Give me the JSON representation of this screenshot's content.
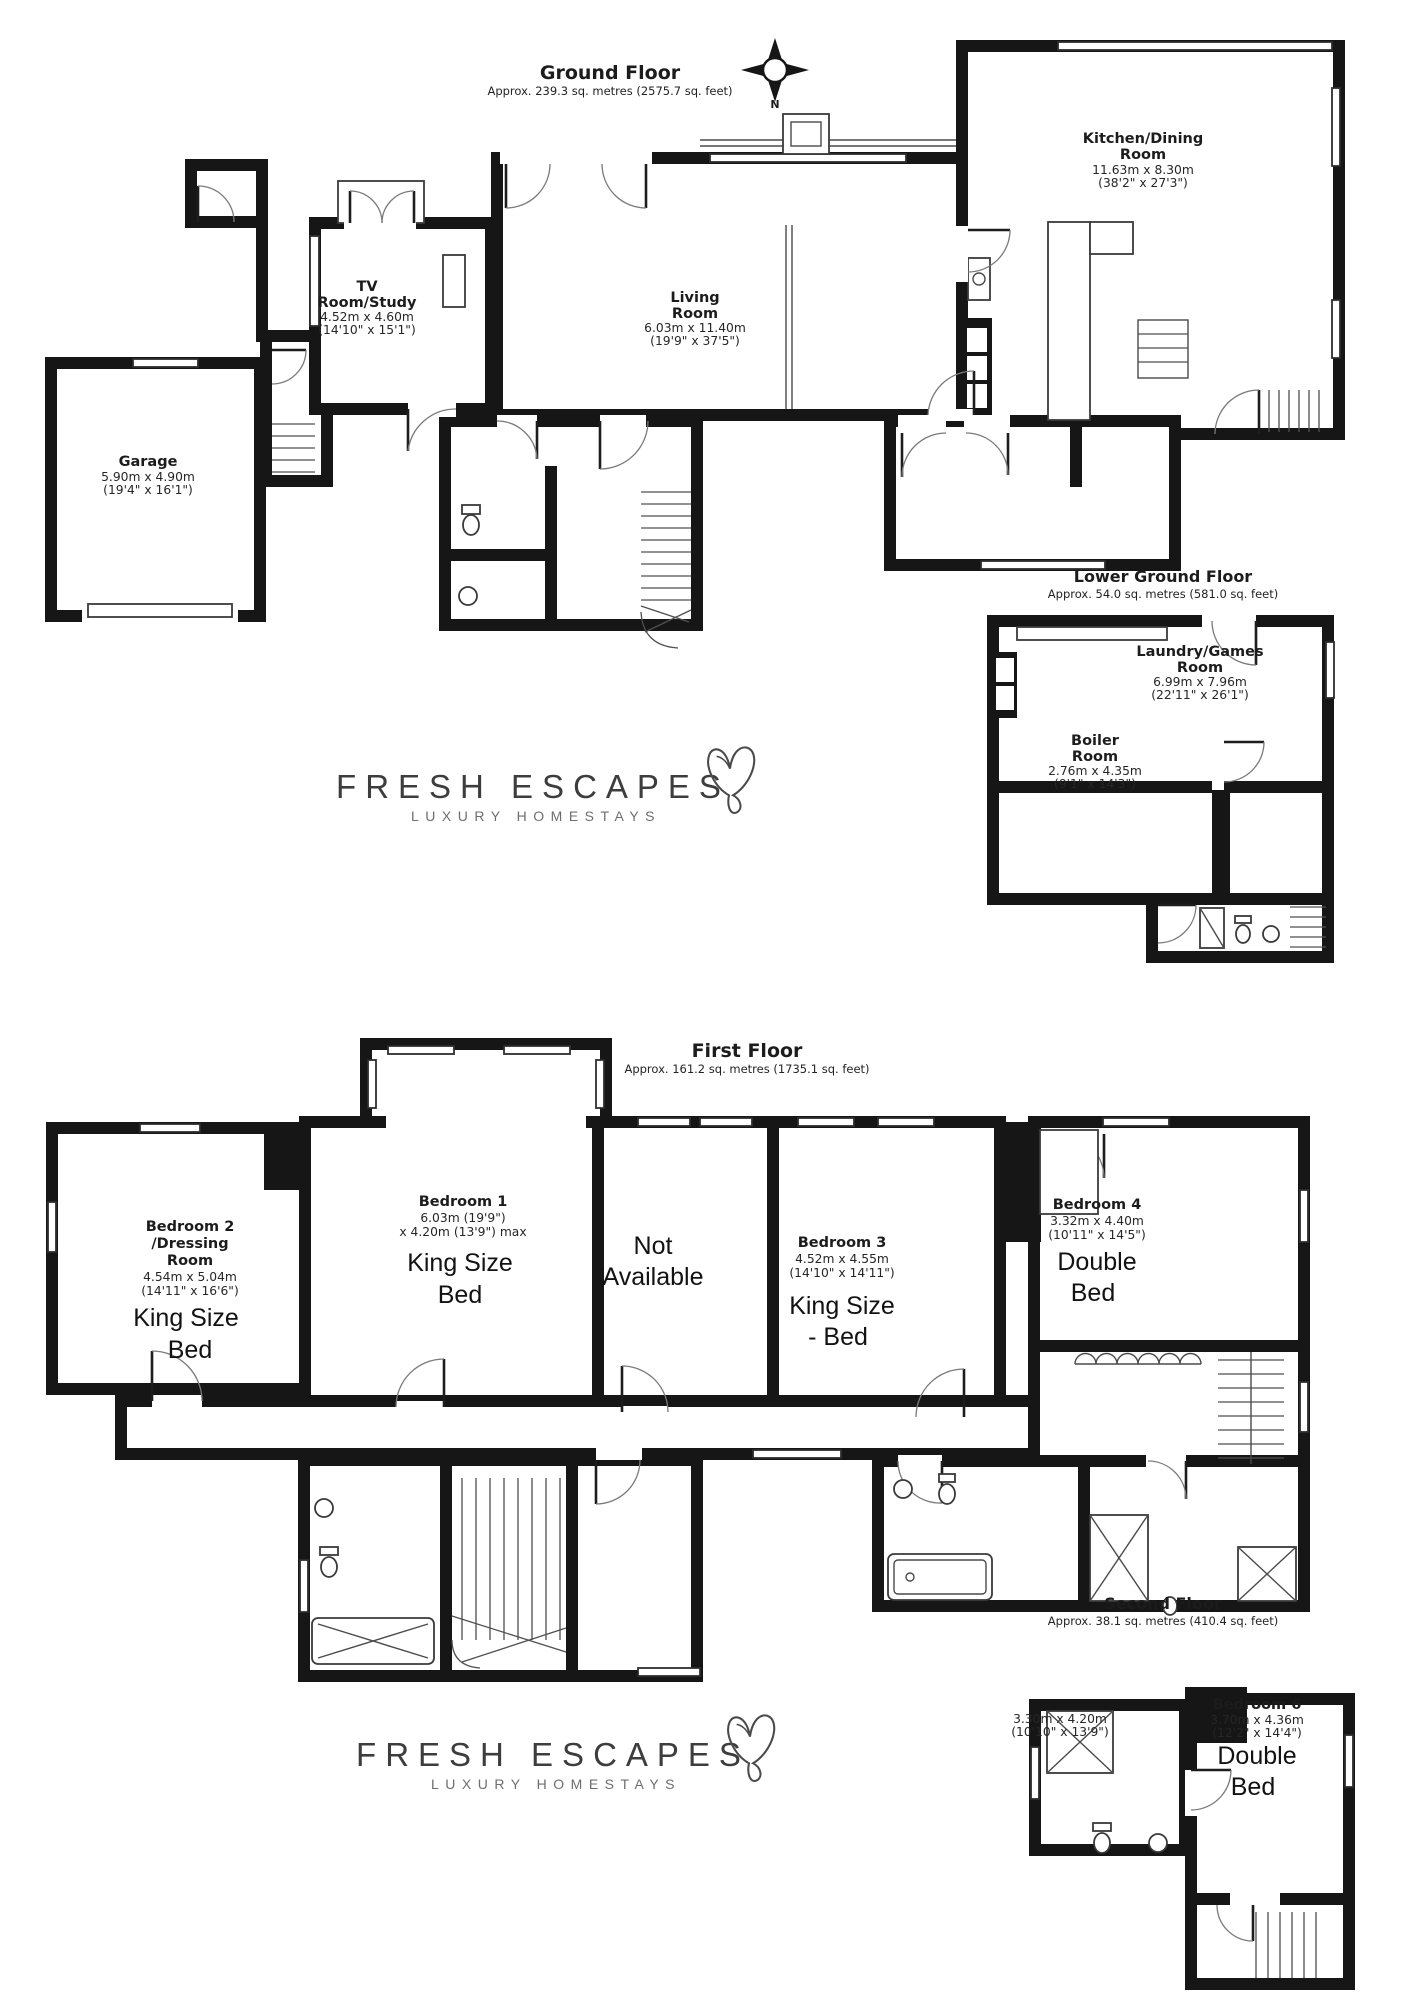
{
  "brand": {
    "name": "FRESH ESCAPES",
    "tagline": "LUXURY HOMESTAYS"
  },
  "compass": {
    "label": "N"
  },
  "colors": {
    "wall": "#161616",
    "text": "#1c1c1c",
    "logo_text": "#3d3d3d",
    "logo_sub": "#6e6e6e"
  },
  "floors": {
    "ground": {
      "title": "Ground Floor",
      "area": "Approx. 239.3 sq. metres (2575.7 sq. feet)",
      "rooms": {
        "kitchen": {
          "l1": "Kitchen/Dining",
          "l2": "Room",
          "m": "11.63m x 8.30m",
          "ft": "(38'2\" x 27'3\")"
        },
        "living": {
          "l1": "Living",
          "l2": "Room",
          "m": "6.03m x 11.40m",
          "ft": "(19'9\" x 37'5\")"
        },
        "tv": {
          "l1": "TV",
          "l2": "Room/Study",
          "m": "4.52m x 4.60m",
          "ft": "(14'10\" x 15'1\")"
        },
        "garage": {
          "l1": "Garage",
          "m": "5.90m x 4.90m",
          "ft": "(19'4\" x 16'1\")"
        }
      }
    },
    "lower": {
      "title": "Lower Ground Floor",
      "area": "Approx. 54.0 sq. metres (581.0 sq. feet)",
      "rooms": {
        "laundry": {
          "l1": "Laundry/Games",
          "l2": "Room",
          "m": "6.99m x 7.96m",
          "ft": "(22'11\" x 26'1\")"
        },
        "boiler": {
          "l1": "Boiler",
          "l2": "Room",
          "m": "2.76m x 4.35m",
          "ft": "(9'1\" x 14'3\")"
        }
      }
    },
    "first": {
      "title": "First Floor",
      "area": "Approx. 161.2 sq. metres (1735.1 sq. feet)",
      "rooms": {
        "bed2": {
          "l1": "Bedroom 2",
          "l2": "/Dressing",
          "l3": "Room",
          "m": "4.54m x 5.04m",
          "ft": "(14'11\" x 16'6\")",
          "a1": "King Size",
          "a2": "Bed"
        },
        "bed1": {
          "l1": "Bedroom 1",
          "m": "6.03m (19'9\")",
          "m2": "x 4.20m (13'9\") max",
          "a1": "King Size",
          "a2": "Bed"
        },
        "na": {
          "a1": "Not",
          "a2": "Available"
        },
        "bed3": {
          "l1": "Bedroom 3",
          "m": "4.52m x 4.55m",
          "ft": "(14'10\" x 14'11\")",
          "a1": "King Size",
          "a2": "- Bed"
        },
        "bed4": {
          "l1": "Bedroom 4",
          "m": "3.32m x 4.40m",
          "ft": "(10'11\" x 14'5\")",
          "a1": "Double",
          "a2": "Bed"
        }
      }
    },
    "second": {
      "title": "Second Floor",
      "area": "Approx. 38.1 sq. metres (410.4 sq. feet)",
      "rooms": {
        "bath": {
          "m": "3.30m x 4.20m",
          "ft": "(10'10\" x 13'9\")"
        },
        "bed6": {
          "l1": "Bedroom 6",
          "m": "3.70m x 4.36m",
          "ft": "(12'2\" x 14'4\")",
          "a1": "Double",
          "a2": "Bed"
        }
      }
    }
  }
}
